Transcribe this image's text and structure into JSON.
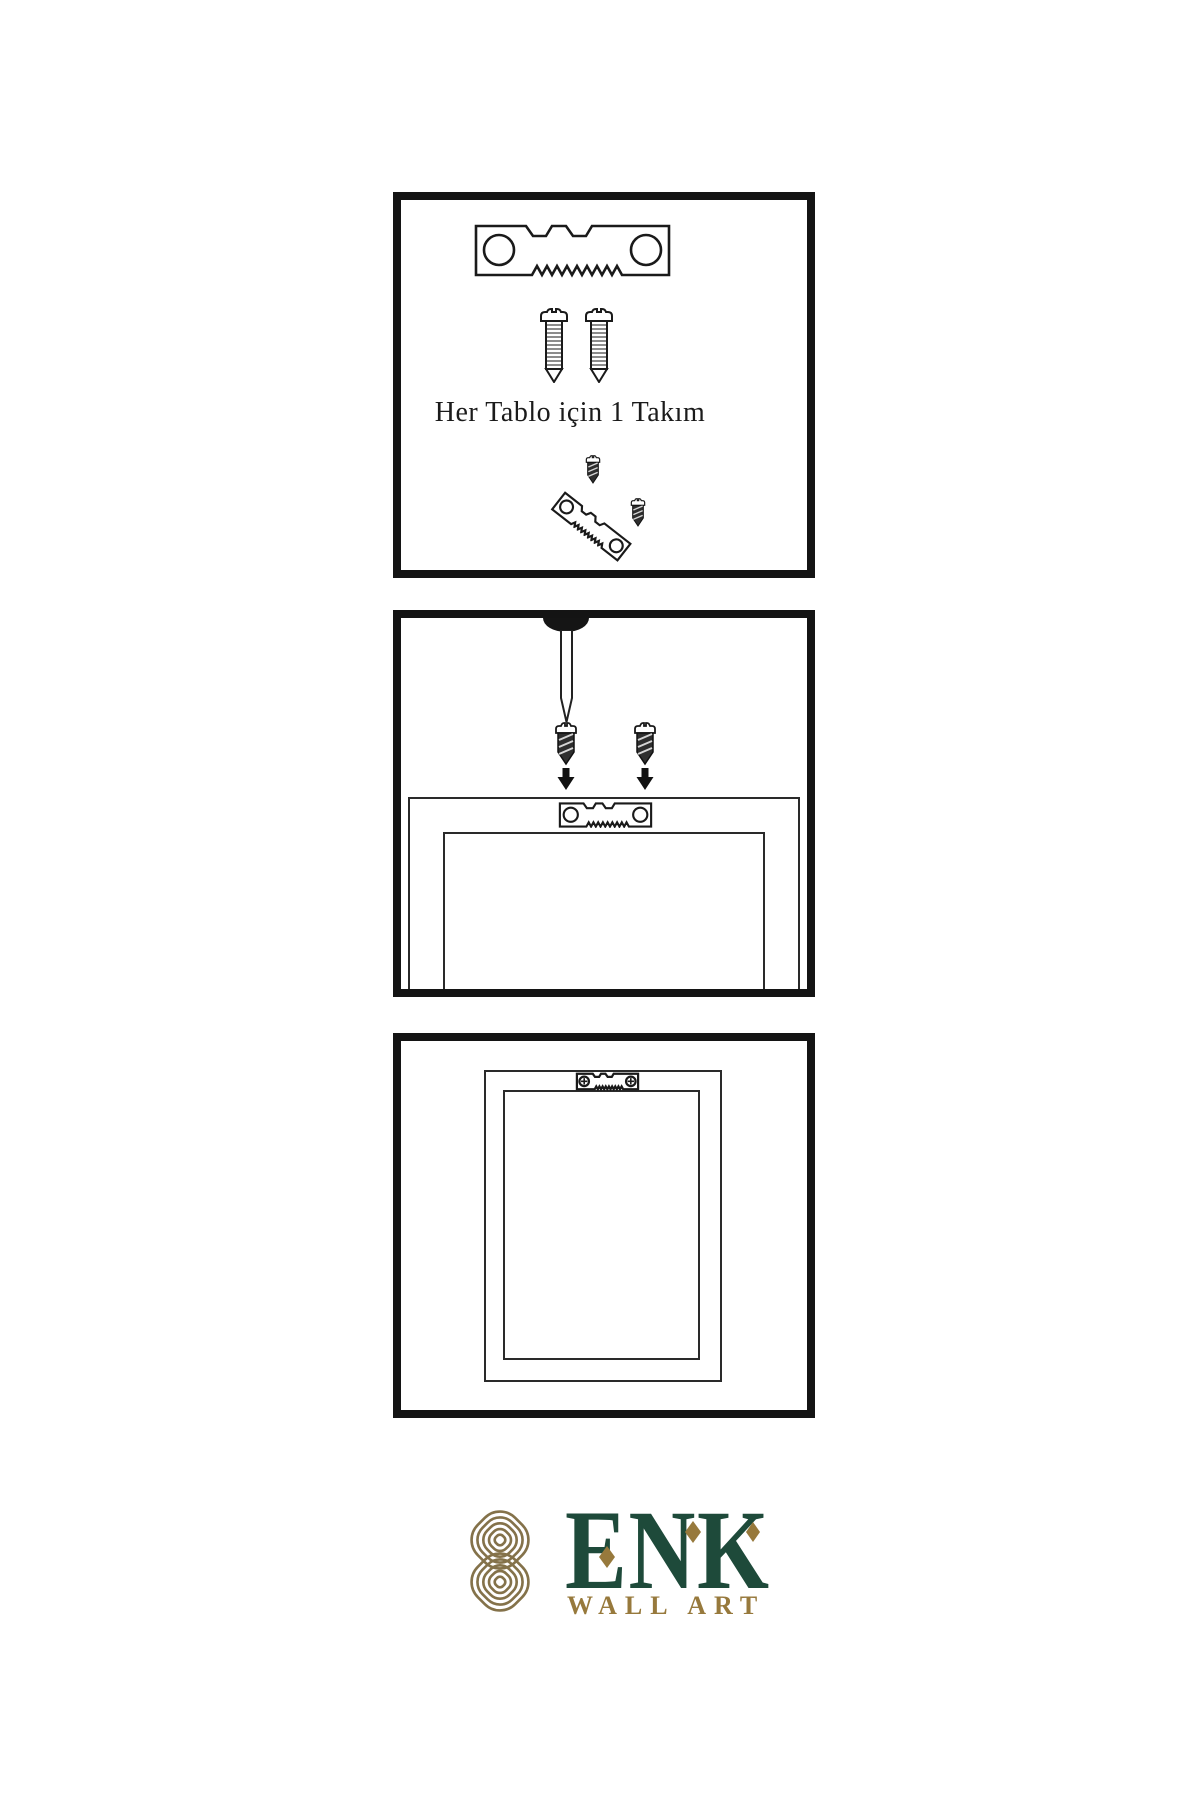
{
  "colors": {
    "ink": "#1a1a1a",
    "panel_border": "#141414",
    "frame_line": "#2a2a2a",
    "logo_green": "#1e4a3a",
    "logo_gold": "#97793c",
    "knot_gold": "#84724a"
  },
  "panels": {
    "kit": {
      "caption": "Her Tablo için 1 Takım",
      "icons": [
        "sawtooth-hanger-icon",
        "screw-icon",
        "screw-icon",
        "dark-screw-icon",
        "tilted-sawtooth-hanger-icon",
        "dark-screw-icon"
      ]
    },
    "mounting": {
      "icons": [
        "wall-nail-icon",
        "dark-screw-icon",
        "dark-screw-icon",
        "down-arrow-icon",
        "down-arrow-icon",
        "sawtooth-hanger-icon",
        "frame-back-outline"
      ]
    },
    "hung": {
      "icons": [
        "frame-outline",
        "mounted-sawtooth-hanger-icon"
      ]
    }
  },
  "logo": {
    "brand": "ENK",
    "subtitle": "WALL ART",
    "icons": [
      "knot-emblem-icon",
      "diamond-icon",
      "diamond-icon",
      "diamond-icon"
    ]
  }
}
